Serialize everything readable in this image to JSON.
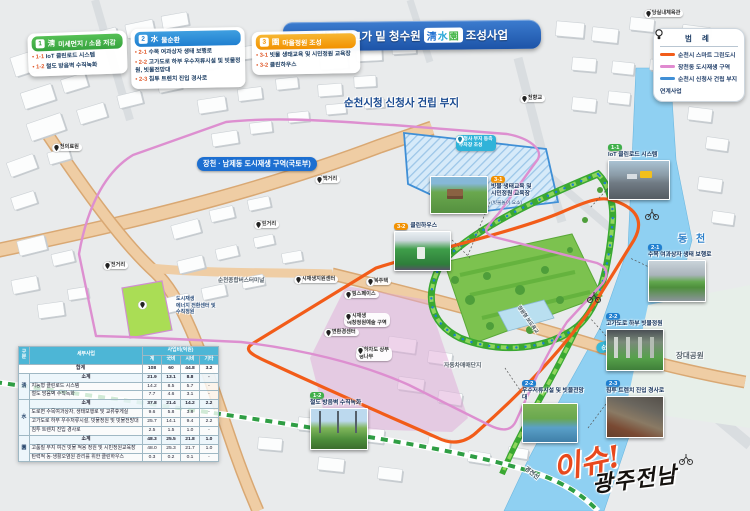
{
  "title": {
    "prefix": "장천동 고가 밑 청수원",
    "hanja": "淸水園",
    "suffix": "조성사업"
  },
  "legend_cards": [
    {
      "num": "1",
      "hanja": "淸",
      "title": "미세먼지 / 소음 저감",
      "items": [
        {
          "id": "1-1",
          "label": "IoT 클린로드 시스템"
        },
        {
          "id": "1-2",
          "label": "철도 방음벽 수직녹화"
        }
      ]
    },
    {
      "num": "2",
      "hanja": "水",
      "title": "물순환",
      "items": [
        {
          "id": "2-1",
          "label": "수목 여과상자 생태 보행로"
        },
        {
          "id": "2-2",
          "label": "고가도로 하부 우수저류시설 및 빗물정원, 빗물전망대"
        },
        {
          "id": "2-3",
          "label": "침투 트렌치 진입 경사로"
        }
      ]
    },
    {
      "num": "3",
      "hanja": "園",
      "title": "마을정원 조성",
      "items": [
        {
          "id": "3-1",
          "label": "빗물 생태교육 및 시민정원 교육장"
        },
        {
          "id": "3-2",
          "label": "클린하우스"
        }
      ]
    }
  ],
  "map_legend": {
    "title": "범 례",
    "items": [
      {
        "label": "순천시 스마트 그린도시",
        "color": "#f25c19"
      },
      {
        "label": "장천동 도시재생 구역",
        "color": "#e08ad0"
      },
      {
        "label": "순천시 신청사 건립 부지",
        "color": "#3f8fd6"
      },
      {
        "label": "연계사업",
        "icon": "bulb-icon"
      }
    ]
  },
  "map_labels": {
    "regen_zone_badge": "장천 · 남제동 도시재생 구역(국토부)",
    "new_cityhall": "순천시청 신청사 건립 부지",
    "parking_badge": "신청사 부지 동측\n주차장 조성",
    "river": "동 천",
    "park": "장대공원",
    "bridge": "순천교",
    "railway": "경전선",
    "car_market": "자동차매매단지",
    "bus_terminal": "순천종합버스터미널",
    "energy_center": "도시재생\n에너지 전환센터 및\n수직정원",
    "garden_footbridge": "정원형 보도육교"
  },
  "callouts": [
    {
      "id": "1-1",
      "label": "IoT 클린로드 시스템"
    },
    {
      "id": "1-2",
      "label": "철도 방음벽 수직녹화"
    },
    {
      "id": "2-1",
      "label": "수목 여과상자 생태 보행로"
    },
    {
      "id": "2-2",
      "label": "고가도로 하부 빗물정원"
    },
    {
      "id": "2-2",
      "label": "우수저류시설 및 빗물전망대"
    },
    {
      "id": "2-3",
      "label": "침투 트렌치 진입 경사로"
    },
    {
      "id": "3-1",
      "label": "빗물 생태교육 및\n시민정원 교육장",
      "sub": "(빗물놀이 요소)"
    },
    {
      "id": "3-2",
      "label": "클린하우스"
    }
  ],
  "pins": [
    {
      "label": "순천의료원"
    },
    {
      "label": "역전거리"
    },
    {
      "label": "열린거리"
    },
    {
      "label": "광백거리"
    },
    {
      "label": "도시재생지원센터"
    },
    {
      "label": "행복주택"
    },
    {
      "label": "팜핑스페이스"
    },
    {
      "label": "도시재생\n예창정원예술 구역"
    },
    {
      "label": "주변환경센터"
    },
    {
      "label": "지하차도 상부\n팽나무"
    },
    {
      "label": "순천향교"
    },
    {
      "label": "금당실내체육관"
    }
  ],
  "table": {
    "col_labels": [
      "구분",
      "세부사업"
    ],
    "group_header": "사업비(억원)",
    "unit_cols": [
      "계",
      "국비",
      "시비",
      "기타"
    ],
    "groups": [
      {
        "name": "",
        "rows": [
          {
            "label": "합계",
            "vals": [
              "108",
              "60",
              "44.8",
              "3.2"
            ],
            "total": true
          }
        ]
      },
      {
        "name": "淸",
        "rows": [
          {
            "label": "소계",
            "vals": [
              "21.9",
              "13.1",
              "8.8",
              "-"
            ],
            "sub": true
          },
          {
            "label": "지능형 클린로드 시스템",
            "vals": [
              "14.2",
              "8.5",
              "5.7",
              "-"
            ]
          },
          {
            "label": "철도 방음벽 수직녹화",
            "vals": [
              "7.7",
              "4.6",
              "3.1",
              "-"
            ]
          }
        ]
      },
      {
        "name": "水",
        "rows": [
          {
            "label": "소계",
            "vals": [
              "37.8",
              "21.4",
              "14.2",
              "2.2"
            ],
            "sub": true
          },
          {
            "label": "도로변 수목여과상자, 생태보행로 및 교류휴게실",
            "vals": [
              "9.6",
              "5.8",
              "3.8",
              "-"
            ]
          },
          {
            "label": "고가도로 하부 우수저류시설, 빗물정원 및 빗물전망대",
            "vals": [
              "25.7",
              "14.1",
              "9.4",
              "2.2"
            ]
          },
          {
            "label": "침투 트렌치 진입 경사로",
            "vals": [
              "2.5",
              "1.5",
              "1.0",
              "-"
            ]
          }
        ]
      },
      {
        "name": "園",
        "rows": [
          {
            "label": "소계",
            "vals": [
              "48.3",
              "25.5",
              "21.8",
              "1.0"
            ],
            "sub": true
          },
          {
            "label": "고품질 부지 여건 빗물 적용 정원 및 시민정원교육장",
            "vals": [
              "48.0",
              "25.3",
              "21.7",
              "1.0"
            ]
          },
          {
            "label": "탄력적 동·생활오염원 관리를 위한 클린하우스",
            "vals": [
              "0.3",
              "0.2",
              "0.1",
              "-"
            ]
          }
        ]
      }
    ]
  },
  "logo": {
    "issue": "이슈!",
    "region": "광주전남"
  },
  "colors": {
    "smart_green_city": "#f25c19",
    "urban_regen_line": "#dd8fd0",
    "new_cityhall_line": "#3f8fd6",
    "card_air": "#36a33e",
    "card_water": "#1f7fd0",
    "card_garden": "#f29100",
    "main_road": "#eac091",
    "river": "#8fd0f2",
    "eco_corridor": "#3aa832"
  }
}
